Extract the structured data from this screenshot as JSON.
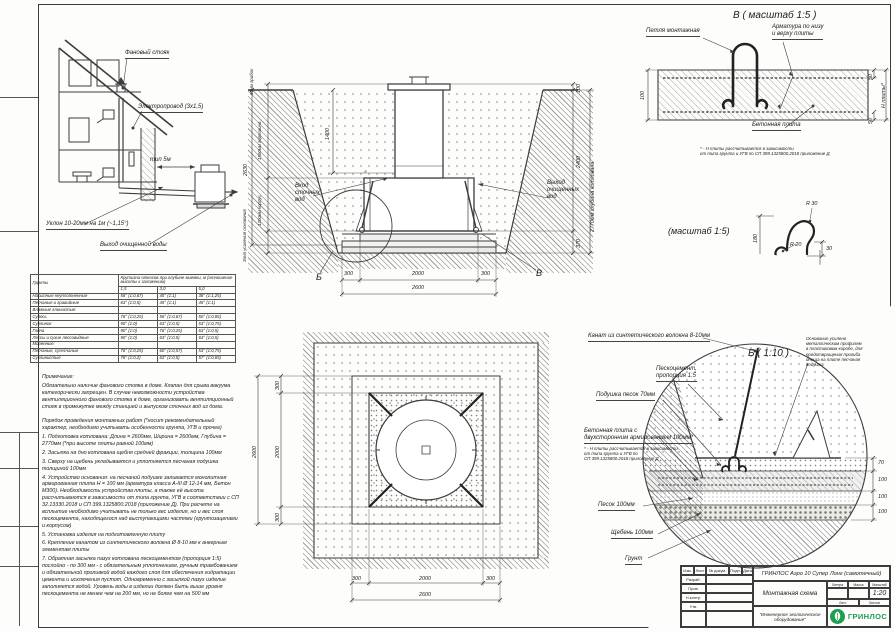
{
  "house_view": {
    "vent_stack": "Фановый стояк",
    "electric": "Электропровод (3х1,5)",
    "typ_5m": "тип 5м",
    "slope": "Уклон 10-20мм на 1м (~1,15°)",
    "clean_out": "Выход очищенной воды"
  },
  "main_section": {
    "dim_total_left": "2630",
    "dim_cap": "60мм\nгрибок",
    "dim_neck": "1500мм горловина",
    "dim_body": "1200мм корпус",
    "zone": "Зона усиления\nоснования",
    "dim_inner": "1400",
    "inlet": "Вход\nсточных\nвод",
    "outlet": "Выход\nочищенных\nвод",
    "dim_top_right": "100",
    "dim_right_station": "2400",
    "dim_right_base": "370",
    "dim_pit_depth": "2770мм глубина котлована",
    "dim_b1": "300",
    "dim_b2": "2000",
    "dim_b3": "300",
    "dim_b_total": "2600",
    "marker_b": "Б",
    "marker_v": "В"
  },
  "detail_v": {
    "title": "В ( масштаб 1:5 )",
    "loop": "Петля монтажная",
    "rebar": "Арматура по низу\nи верху плиты",
    "slab": "Бетонная плита",
    "dim_100": "100",
    "dim_50_top": "50",
    "dim_50_bot": "50",
    "dim_h": "Н плиты*",
    "footnote": "* - Н плиты рассчитывается в зависимости\nот типа грунта и УГВ по СП 399.1325800.2018 приложение Д"
  },
  "hook_detail": {
    "title": "(масштаб 1:5)",
    "r30": "R 30",
    "r20": "R 20",
    "d180": "180",
    "d240": "240",
    "d30": "30"
  },
  "detail_b": {
    "title": "Б ( 1:10 )",
    "rope": "Канат из синтетического волокна 8-10мм",
    "sandcement": "Пескоцемент,\nпропорция 1:5",
    "cushion": "Подушка песок 70мм",
    "plate": "Бетонная плита с\nдвухсторонним армированием 100мм*",
    "footnote": "* - Н плиты рассчитывается в зависимости\nот типа грунта и УГВ по\nСП 399.1325800.2018 приложение Д",
    "sand": "Песок 100мм",
    "gravel": "Щебень 100мм",
    "soil": "Грунт",
    "note_right": "Основание усилено\nметаллическим профилем\nв пластиковом коробе, для\nпредотвращения прогиба\nднища на плите песчаная\nподушка",
    "dim_70": "70",
    "dim_100a": "100",
    "dim_100b": "100",
    "dim_100c": "100"
  },
  "plan_view": {
    "left_total": "2600",
    "left_300a": "300",
    "left_2000": "2000",
    "left_300b": "300",
    "bot_300a": "300",
    "bot_2000": "2000",
    "bot_300b": "300",
    "bot_total": "2600"
  },
  "slope_table": {
    "col_soil": "Грунты",
    "header": "Крутизна откосов при глубине выемки, м (отношение высоты к заложению)",
    "cols": [
      "1,5",
      "3,0",
      "5,0"
    ],
    "rows": [
      {
        "name": "Насыпные неуплотненные",
        "c1": "56° (1:0,67)",
        "c2": "45° (1:1)",
        "c3": "38° (1:1,25)"
      },
      {
        "name": "Песчаные и гравийные",
        "c1": "63° (1:0,5)",
        "c2": "45° (1:1)",
        "c3": "45° (1:1)"
      },
      {
        "name": "Влажные глинистые:",
        "c1": "",
        "c2": "",
        "c3": ""
      },
      {
        "name": "Супесь",
        "c1": "76° (1:0,25)",
        "c2": "56° (1:0,67)",
        "c3": "50° (1:0,85)"
      },
      {
        "name": "Суглинок",
        "c1": "90° (1:0)",
        "c2": "63° (1:0,5)",
        "c3": "53° (1:0,75)"
      },
      {
        "name": "Глина",
        "c1": "90° (1:0)",
        "c2": "76° (1:0,25)",
        "c3": "63° (1:0,5)"
      },
      {
        "name": "Лессы и сухие лессовидные",
        "c1": "90° (1:0)",
        "c2": "63° (1:0,5)",
        "c3": "63° (1:0,5)"
      },
      {
        "name": "Моренные:",
        "c1": "",
        "c2": "",
        "c3": ""
      },
      {
        "name": "Песчаные, супесчаные",
        "c1": "76° (1:0,25)",
        "c2": "60° (1:0,57)",
        "c3": "53° (1:0,75)"
      },
      {
        "name": "Суглинистые",
        "c1": "78° (1:0,2)",
        "c2": "63° (1:0,5)",
        "c3": "57° (1:0,65)"
      }
    ]
  },
  "notes": {
    "title": "Примечание:",
    "p1": "Обязательно наличие фанового стояка в доме. Клапан для срыва вакуума категорически запрещен. В случае невозможности устройства вентиляционного фанового стояка в доме, организовать вентиляционный стояк в промежутке между станцией и выпуском сточных вод из дома.",
    "p2": "Порядок проведения монтажных работ (*носит рекомендательный характер, необходимо учитывать особенности грунта, УГВ и прочее)",
    "items": [
      "1. Подготовка котлована: Длина = 2600мм,  Ширина = 2600мм, Глубина = 2770мм (*при высоте плиты равной 100мм)",
      "2. Засыпка на дно котлована щебня средней фракции, толщина 100мм",
      "3. Сверху на щебень укладывается и уплотняется песчаная подушка толщиной 100мм",
      "4. Устройство основания: на песчаной подушке заливается монолитная армированная плита Н = 100 мм (арматура класса А-III Ø 12-14 мм, Бетон М300). Необходимость устройства плиты, а также её высота рассчитываются в зависимости от типа грунта, УГВ в соответствии с СП 32.13330.2018 и СП 399.1325800.2018 (приложение Д). При расчете на всплытие необходимо учитывать не только вес изделия, но и вес слоя пескоцемента, находящегося над выступающими частями (грунтозацепами и корпусом)",
      "5. Установка изделия на подготовленную плиту",
      "6. Крепление канатом из синтетического волокна Ø 8-10 мм к анкерным элементам плиты",
      "7. Обратная засыпка пазух котлована пескоцементом (пропорция 1:5) послойно - по 300 мм - с обязательным уплотнением, ручным трамбованием и обязательной проливкой водой каждого слоя для обеспечения гидратации цемента и исключения пустот. Одновременно с засыпкой пазух изделие заполняется водой. Уровень воды в изделии должен быть выше уровня пескоцемента не менее чем на 200 мм, но не более чем на 500 мм"
    ]
  },
  "title_block": {
    "product": "ГРИНЛОС Аэро 10 Супер Лонг (самотечный)",
    "doc_type": "Монтажная схема",
    "h_litera": "Литера",
    "h_massa": "Масса",
    "h_scale": "Масштаб",
    "scale": "1:20",
    "h_sheet": "Лист",
    "h_sheets": "Листов",
    "tagline": "\"Инженерное экологическое оборудование\"",
    "brand": "ГРИНЛОС",
    "c_izm": "Изм.",
    "c_list": "Лист",
    "c_doc": "№ докум.",
    "c_sign": "Подп.",
    "c_date": "Дата",
    "r1": "Разраб.",
    "r2": "Пров.",
    "r3": "Н.контр.",
    "r4": "Утв."
  }
}
